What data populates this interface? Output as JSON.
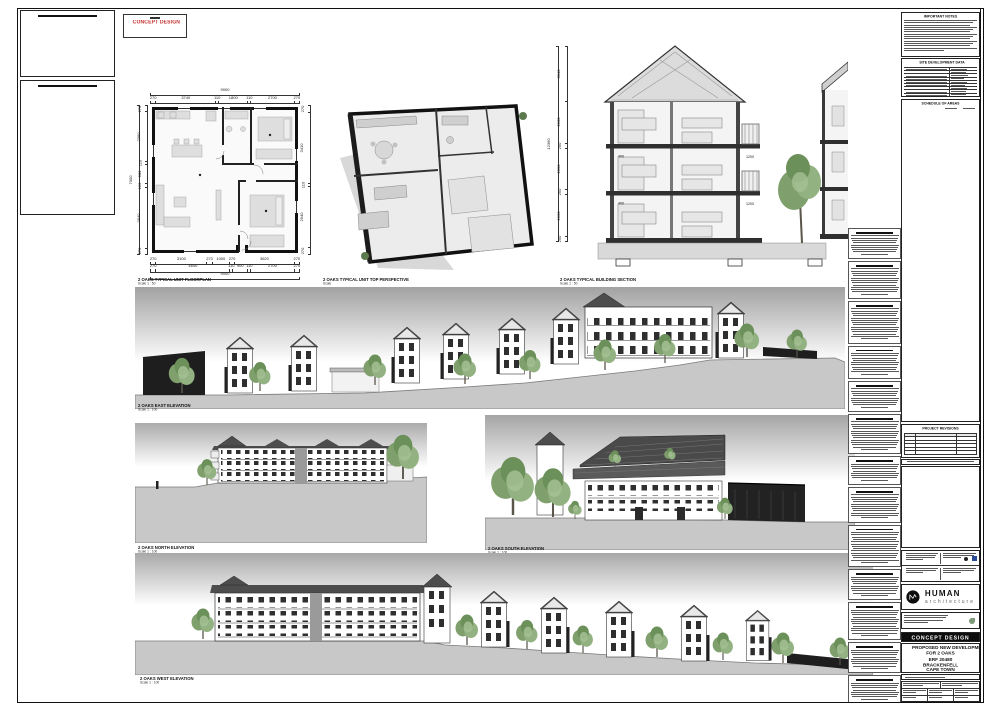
{
  "stamp": {
    "label": "CONCEPT DESIGN"
  },
  "captions": {
    "floorplan": {
      "title": "2 OAKS TYPICAL UNIT FLOORPLAN",
      "scale": "Scale 1 : 50"
    },
    "perspective": {
      "title": "2 OAKS TYPICAL UNIT TOP PERSPECTIVE",
      "scale": "Scale"
    },
    "section": {
      "title": "2 OAKS TYPICAL BUILDING SECTION",
      "scale": "Scale 1 : 50"
    },
    "east": {
      "title": "2 OAKS EAST ELEVATION",
      "scale": "Scale 1 : 100"
    },
    "north": {
      "title": "2 OAKS NORTH ELEVATION",
      "scale": "Scale 1 : 100"
    },
    "south": {
      "title": "2 OAKS SOUTH ELEVATION",
      "scale": "Scale 1 : 100"
    },
    "west": {
      "title": "2 OAKS WEST ELEVATION",
      "scale": "Scale 1 : 100"
    }
  },
  "floorplan_dims": {
    "top_total": [
      "9000"
    ],
    "top": [
      "270",
      "3740",
      "110",
      "1800",
      "110",
      "2700",
      "270"
    ],
    "bottom1": [
      "270",
      "3100",
      "270",
      "1000",
      "270",
      "3620",
      "270"
    ],
    "bottom2": [
      "270",
      "4640",
      "110",
      "900",
      "110",
      "2700",
      "270"
    ],
    "bottom_total": [
      "9000"
    ],
    "left": [
      "270",
      "2390",
      "110",
      "900",
      "120",
      "2940",
      "270"
    ],
    "left_total": [
      "7000"
    ],
    "right": [
      "270",
      "3410",
      "110",
      "2940",
      "270"
    ]
  },
  "section_dims": {
    "segments": [
      "3540",
      "2690",
      "250",
      "2690",
      "250",
      "2690",
      "250"
    ],
    "total": [
      "12360"
    ],
    "slab": "400",
    "balcony": "1200"
  },
  "titleblock": {
    "important_notes": "IMPORTANT NOTES",
    "site_data": "SITE DEVELOPMENT DATA",
    "areas": "SCHEDULE OF AREAS",
    "revisions": "PROJECT REVISIONS",
    "banner": "CONCEPT DESIGN",
    "logo_name": "HUMAN",
    "logo_sub": "architecture",
    "project_lines": [
      "PROPOSED NEW DEVELOPMENT",
      "FOR 2 OAKS",
      "ERF 20480",
      "BRACKENFELL",
      "CAPE TOWN"
    ]
  },
  "notes_column": {
    "blocks": [
      {
        "lines": 9
      },
      {
        "lines": 12
      },
      {
        "lines": 14
      },
      {
        "lines": 10
      },
      {
        "lines": 9
      },
      {
        "lines": 13
      },
      {
        "lines": 8
      },
      {
        "lines": 11
      },
      {
        "lines": 14
      },
      {
        "lines": 9
      },
      {
        "lines": 12
      },
      {
        "lines": 9
      },
      {
        "lines": 8
      },
      {
        "lines": 10
      }
    ]
  },
  "colors": {
    "stamp_red": "#c62f2f",
    "paper": "#ffffff",
    "line": "#1a1a1a",
    "roof_gray": "#4f4f4f",
    "ground_gray": "#c8c8c8",
    "tree_green": "#7fa06d",
    "banner_bg": "#0d0d0d",
    "consultant_blue": "#2a4d9b"
  }
}
